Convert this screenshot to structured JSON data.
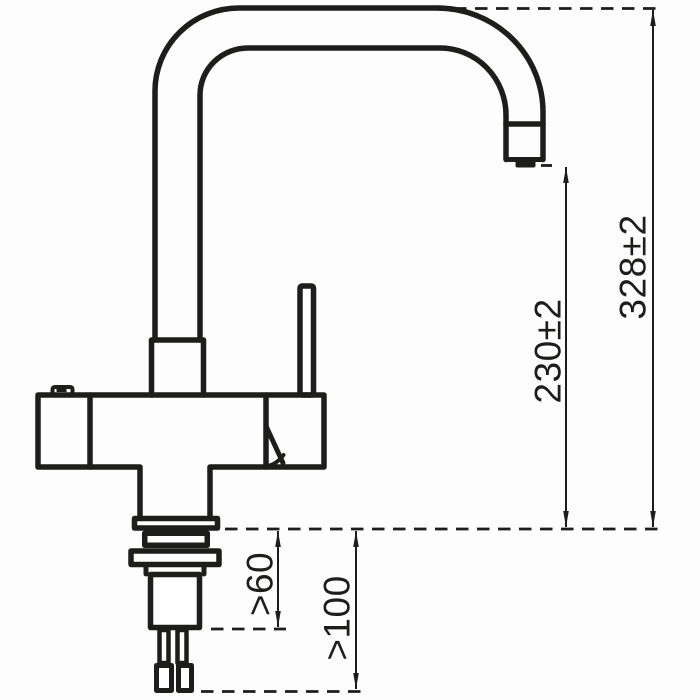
{
  "drawing": {
    "background_color": "#ffffff",
    "line_color": "#1d1d1b",
    "dimensions": {
      "overall_height": "328±2",
      "spout_outlet_height": "230±2",
      "mounting_min_60": ">60",
      "mounting_min_100": ">100"
    }
  }
}
